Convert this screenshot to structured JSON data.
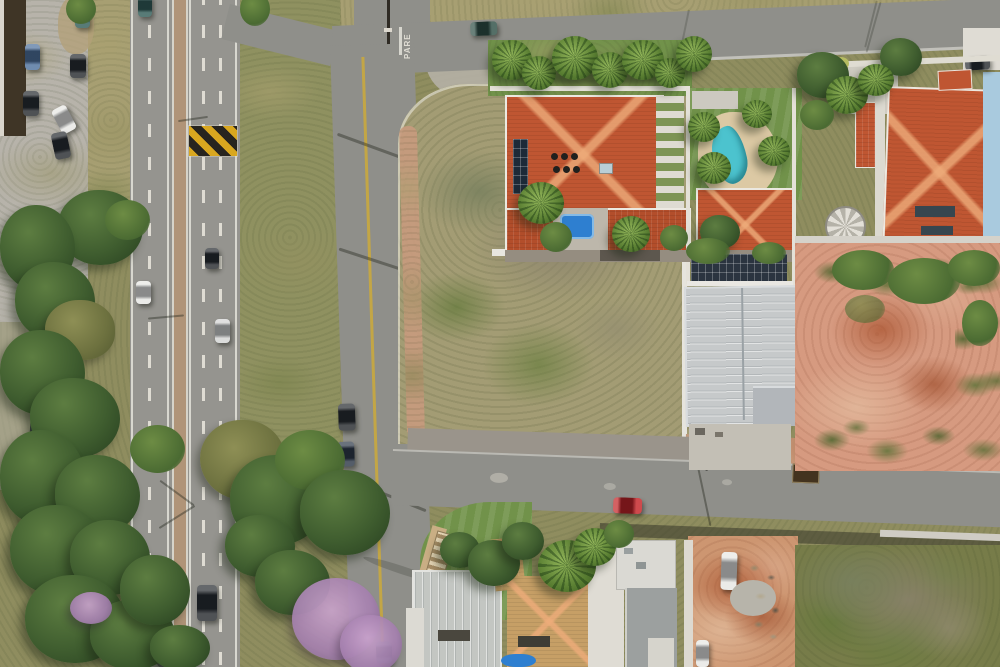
{
  "scene": {
    "type": "aerial-drone-photo",
    "description": "Top-down drone view of a suburban corner: divided highway at left with yellow-black speed bump, service street with yellow center line, vacant scrub corner lot, terracotta-roof houses with swimming pools and solar panels, white ribbed warehouse, bare pink dirt lot, tree-lined verges, parked cars and a red car on the south street.",
    "stop_marking": "PARE"
  },
  "palette": {
    "grass": "#8f8d5f",
    "verge": "#8f9160",
    "dry_grass": "#a79f72",
    "concrete": "#b7b3aa",
    "highway_asphalt": "#95948f",
    "street_asphalt": "#8f8f8a",
    "median_dirt": "#b09478",
    "lane_white": "#e9e7de",
    "center_yellow": "#c9a93e",
    "crosswalk_yellow": "#d9a71f",
    "crosswalk_black": "#27241f",
    "sidewalk_dirt": "#c09a7e",
    "lot_scrub": "#a39c74",
    "lot_dirt_edge": "#c89b7e",
    "dirt_pink": "#d69a80",
    "dirt_red": "#a8502c",
    "construction_dirt": "#cd9671",
    "scrub_dark": "#777c49",
    "roof_orange": "#bf5632",
    "roof_orange_dark": "#b34e2b",
    "roof_tan": "#c69f66",
    "roof_gray": "#c3c6c2",
    "roof_white": "#dfdcd4",
    "warehouse_roof": "#c6c9ca",
    "warehouse_dark": "#2b3440",
    "solar_panel": "#1d2a38",
    "pool_blue": "#2e7fd0",
    "pool_teal": "#4cc3ce",
    "lawn_green": "#71924a",
    "blue_wall": "#a9cade",
    "stone_tan": "#c9ae84",
    "tree_dark": "#3f5d2f",
    "bloom_purple": "#a47fae",
    "car_white": "#e6e6e3",
    "car_silver": "#d2d3d2",
    "car_dark": "#23272b",
    "car_blue": "#4b6f9b",
    "car_navy": "#2a3544",
    "car_red": "#c21d20",
    "car_teal": "#2e5a55",
    "car_green": "#2a4b41"
  }
}
